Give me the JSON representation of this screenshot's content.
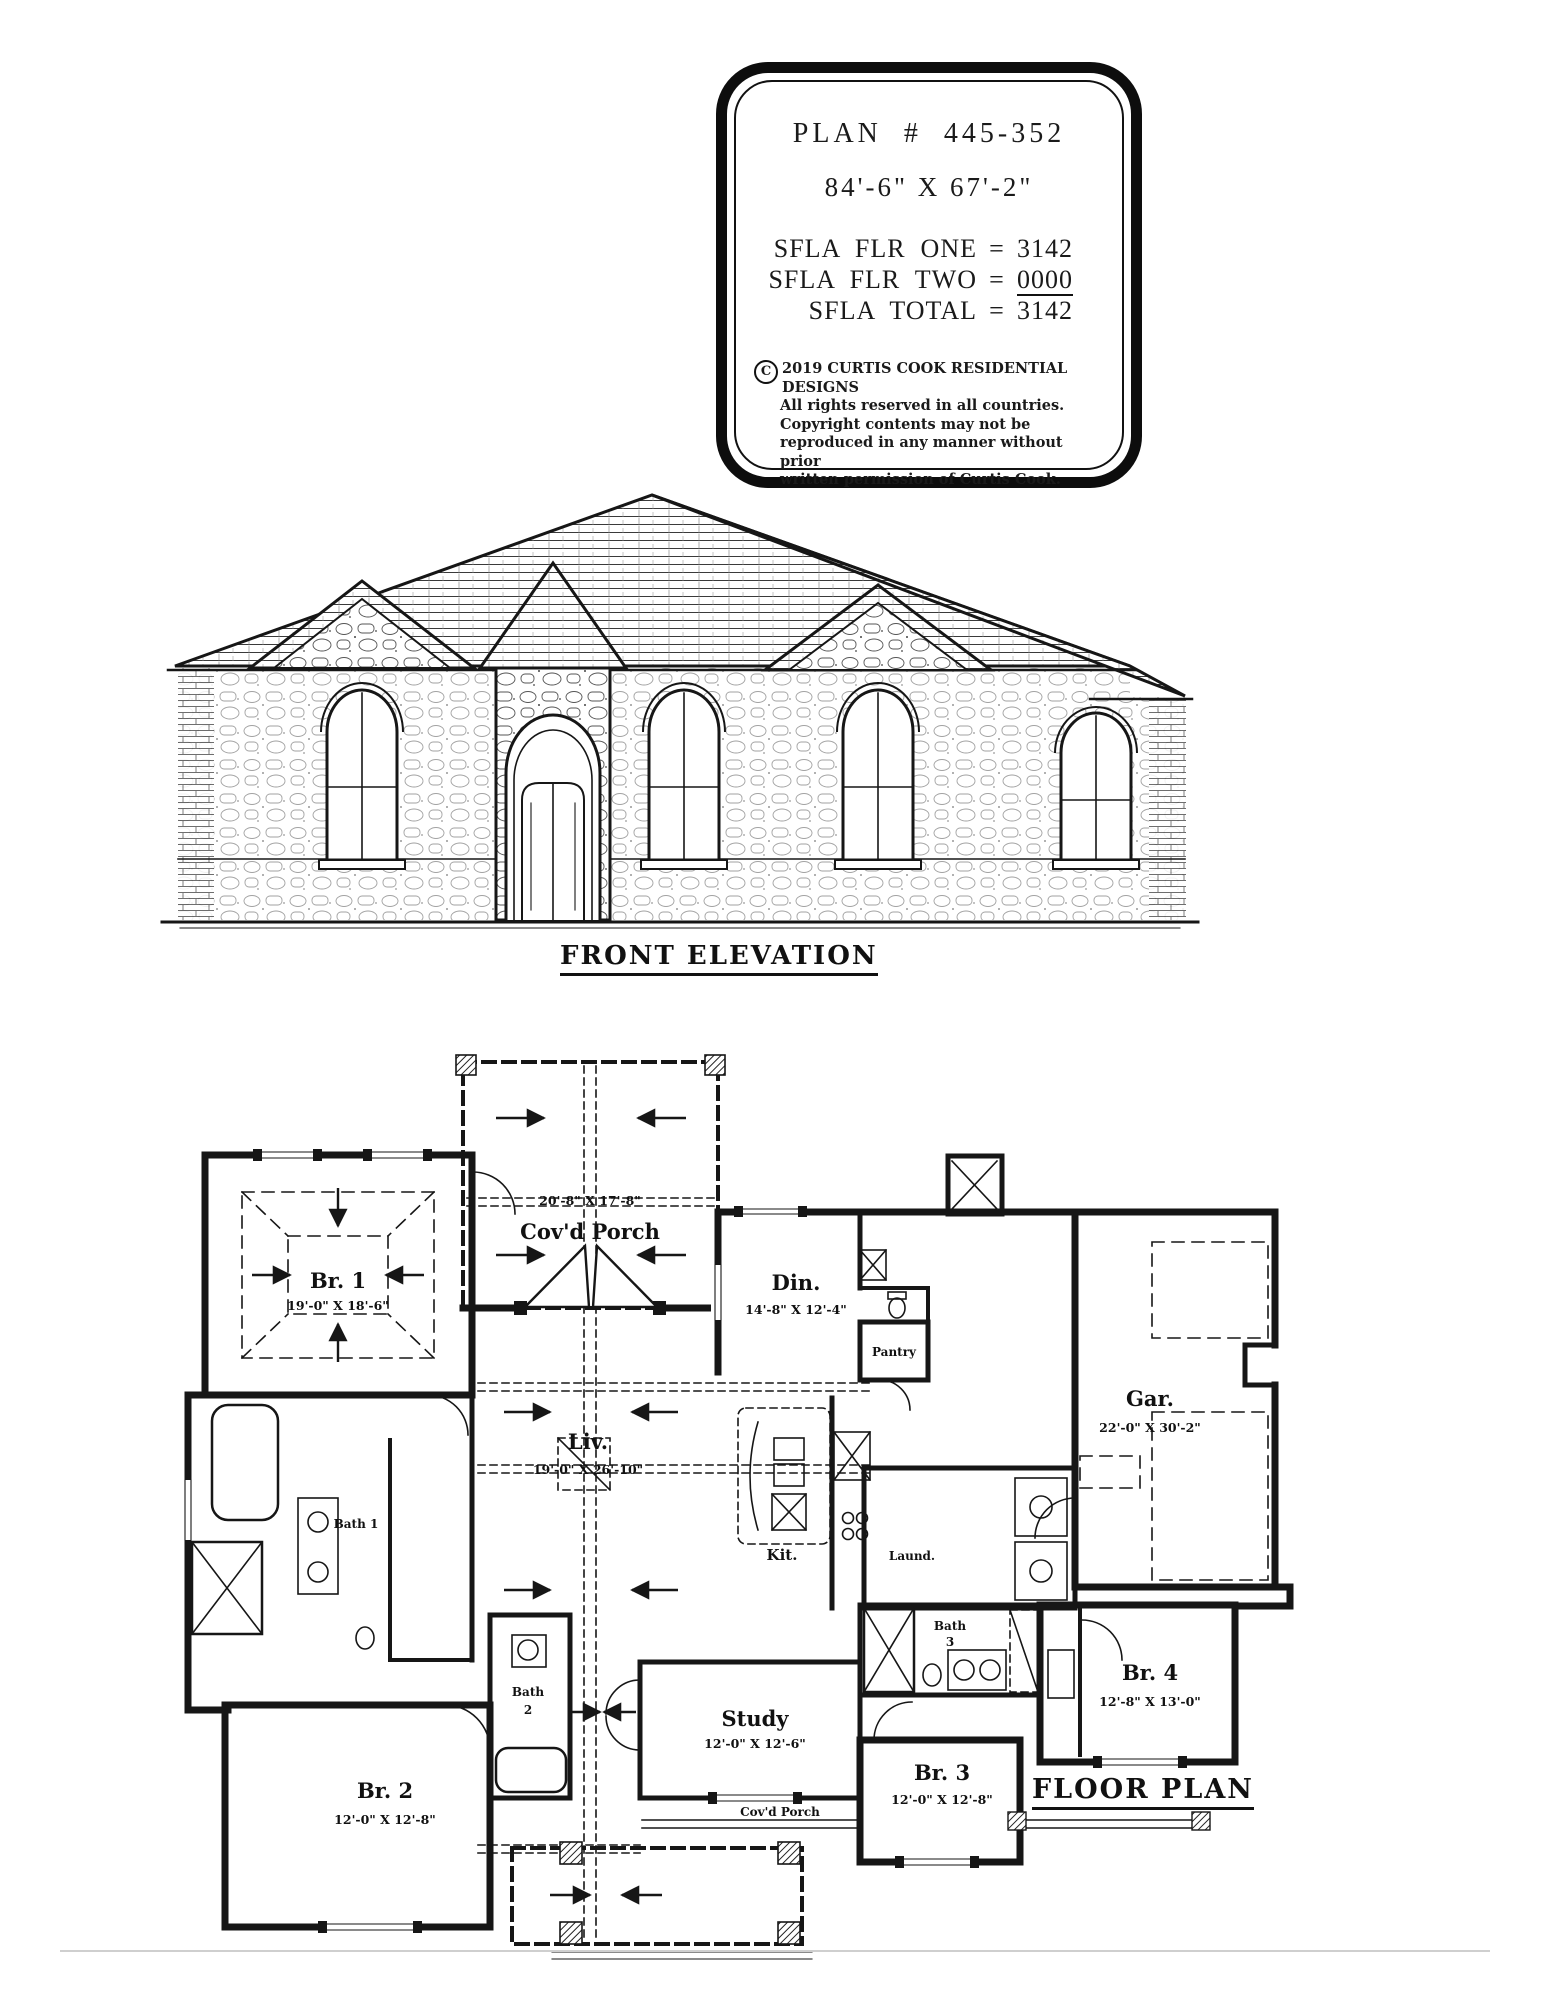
{
  "page": {
    "paper_color": "#ffffff",
    "ink_color": "#1a1a1a"
  },
  "title_block": {
    "plan_number": "PLAN  #  445-352",
    "overall_dimensions": "84'-6\" X 67'-2\"",
    "eq": "=",
    "sfla": [
      {
        "label": "SFLA  FLR  ONE",
        "value": "3142"
      },
      {
        "label": "SFLA  FLR  TWO",
        "value": "0000"
      },
      {
        "label": "SFLA  TOTAL",
        "value": "3142"
      }
    ],
    "copyright": {
      "symbol": "C",
      "line1": "2019  CURTIS  COOK  RESIDENTIAL  DESIGNS",
      "line2": "All rights reserved in all countries.",
      "line3": "Copyright contents may not be",
      "line4": "reproduced in any manner without prior",
      "line5": "written permission of Curtis Cook."
    }
  },
  "front_elevation": {
    "title": "FRONT  ELEVATION"
  },
  "floor_plan": {
    "title": "FLOOR  PLAN",
    "rooms": {
      "covd_porch_top": {
        "name": "Cov'd Porch",
        "dim": "20'-8\" X 17'-8\""
      },
      "br1": {
        "name": "Br. 1",
        "dim": "19'-0\" X 18'-6\""
      },
      "din": {
        "name": "Din.",
        "dim": "14'-8\" X 12'-4\""
      },
      "pantry": {
        "name": "Pantry"
      },
      "gar": {
        "name": "Gar.",
        "dim": "22'-0\" X 30'-2\""
      },
      "liv": {
        "name": "Liv.",
        "dim": "19'-0\" X 26'-10\""
      },
      "kit": {
        "name": "Kit."
      },
      "laund": {
        "name": "Laund."
      },
      "bath1": {
        "name": "Bath 1"
      },
      "bath2": {
        "line1": "Bath",
        "line2": "2"
      },
      "bath3": {
        "line1": "Bath",
        "line2": "3"
      },
      "study": {
        "name": "Study",
        "dim": "12'-0\" X 12'-6\""
      },
      "br2": {
        "name": "Br. 2",
        "dim": "12'-0\" X 12'-8\""
      },
      "br3": {
        "name": "Br. 3",
        "dim": "12'-0\" X 12'-8\""
      },
      "br4": {
        "name": "Br. 4",
        "dim": "12'-8\" X 13'-0\""
      },
      "covd_porch_bottom": {
        "name": "Cov'd Porch"
      }
    }
  }
}
